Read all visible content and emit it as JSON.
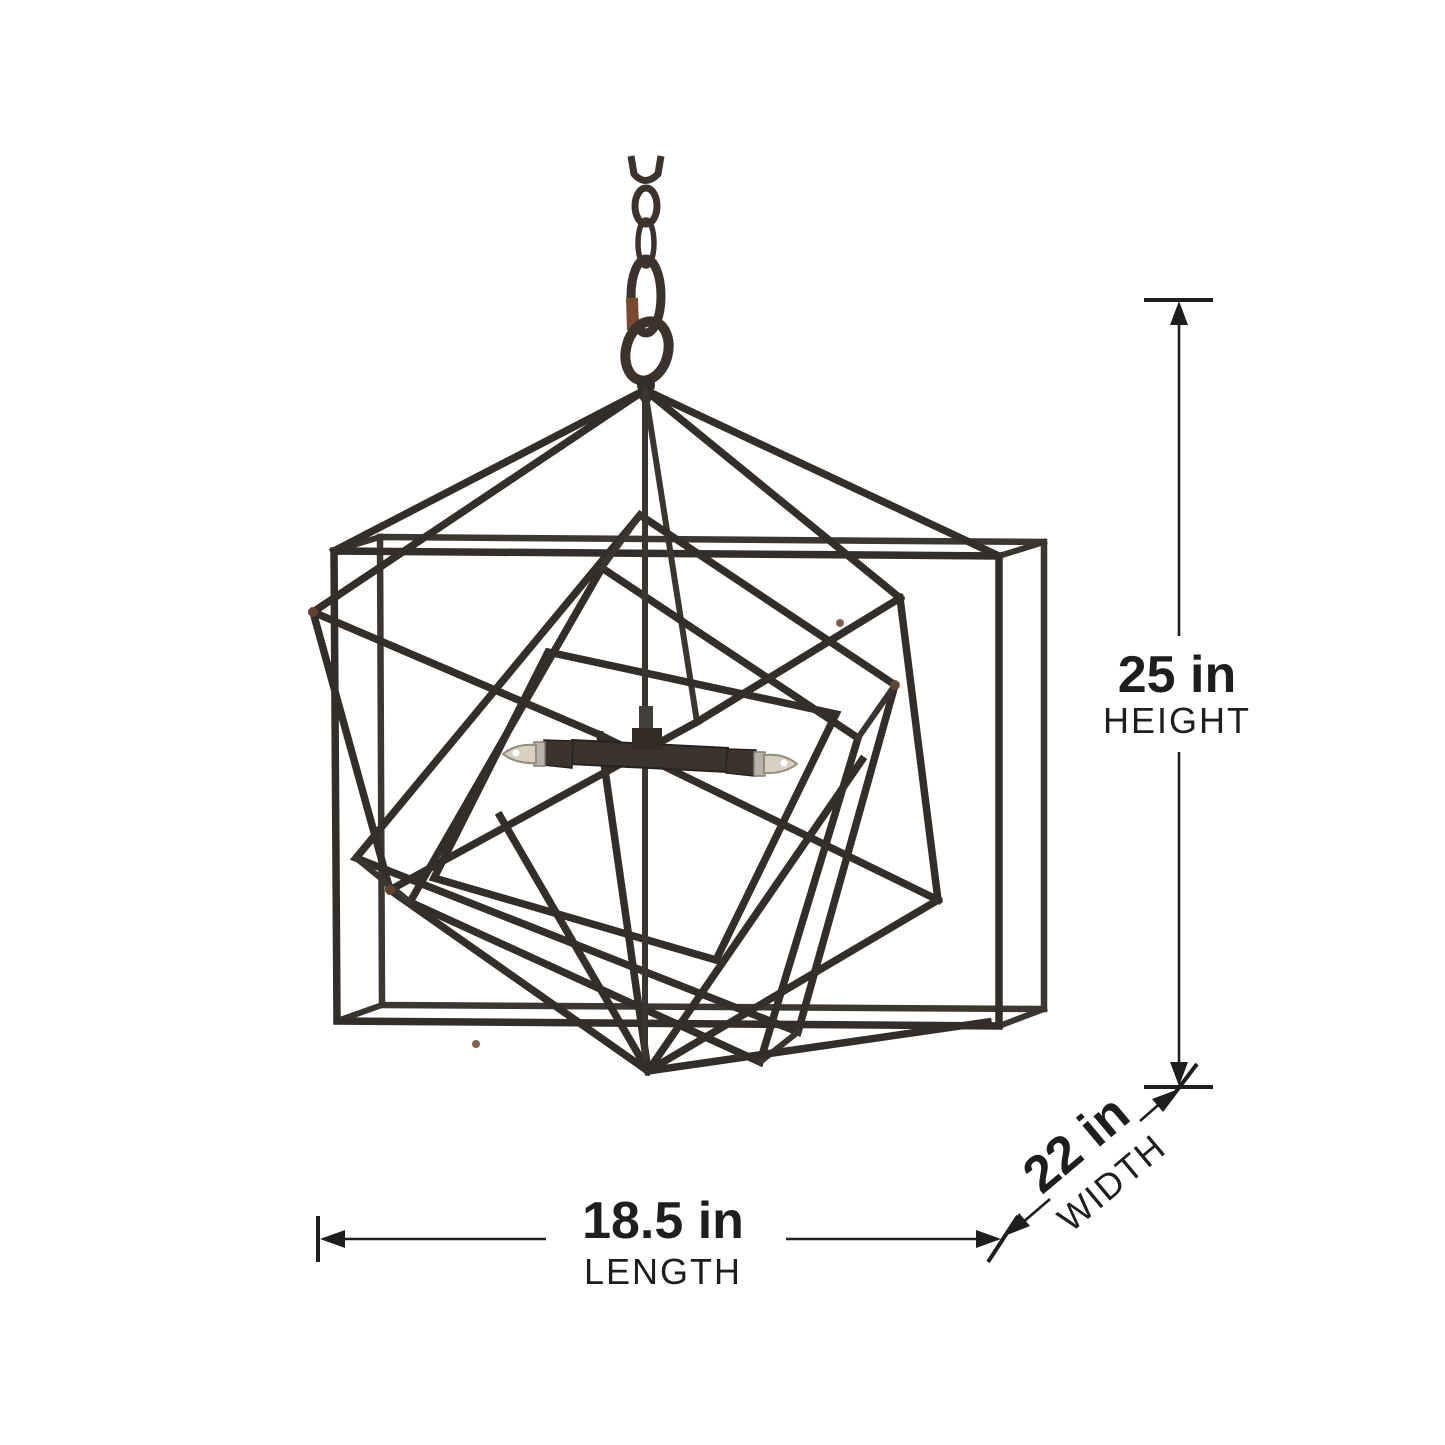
{
  "diagram": {
    "type": "product-dimension-diagram",
    "subject": "nested-cube geometric pendant chandelier",
    "dimensions": {
      "height": {
        "value": "25 in",
        "label": "HEIGHT"
      },
      "width": {
        "value": "22 in",
        "label": "WIDTH"
      },
      "length": {
        "value": "18.5 in",
        "label": "LENGTH"
      }
    },
    "colors": {
      "annotation": "#1e1e1e",
      "frame_metal": "#332e29",
      "rust_accent": "#6b4631",
      "bulb_glass": "#d8d1c1",
      "background": "#ffffff"
    },
    "lights_visible_count": "2"
  }
}
